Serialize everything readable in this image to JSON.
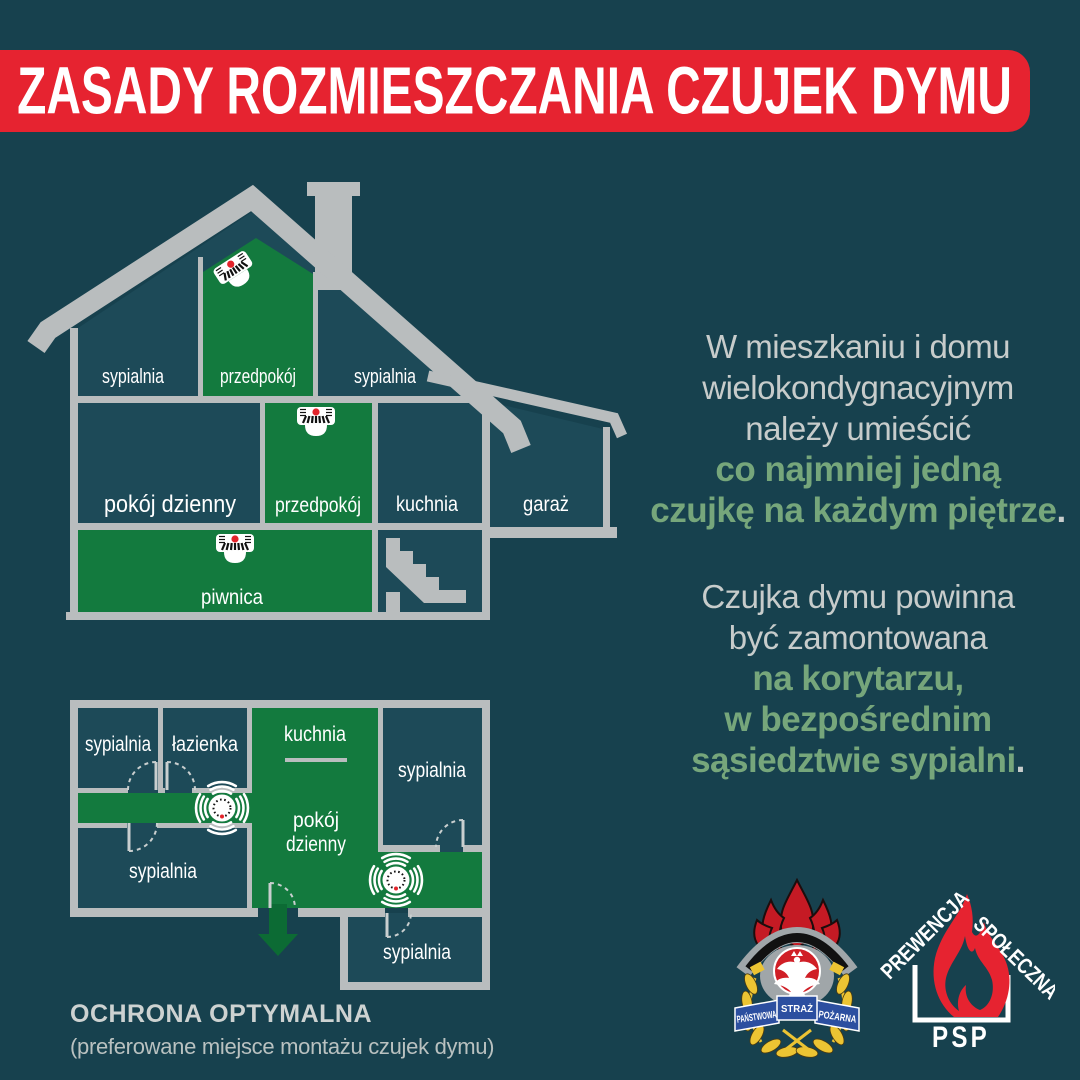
{
  "banner": {
    "title": "ZASADY ROZMIESZCZANIA CZUJEK DYMU"
  },
  "colors": {
    "background": "#17414e",
    "room_fill": "#1d4a58",
    "highlight_green": "#137a3e",
    "arrow_green": "#0c6b34",
    "wall_gray": "#b9bdbe",
    "banner_red": "#e62330",
    "detector_led_red": "#e3242b",
    "info_text_gray": "#c7cccb",
    "info_text_green": "#76a67b",
    "ribbon_blue": "#2c4fa0",
    "laurel_gold": "#ecc433",
    "helmet_gray": "#a0a6a9",
    "crest_flame_red": "#c51a24"
  },
  "icons": {
    "detector_side": "smoke-detector-side-view",
    "detector_top": "smoke-detector-top-view",
    "exit_arrow": "arrow-down",
    "stairs": "staircase",
    "doors": "door-swing-arc"
  },
  "house_section": {
    "attic_bedroom_left": "sypialnia",
    "attic_hallway": "przedpokój",
    "attic_bedroom_right": "sypialnia",
    "living_room": "pokój dzienny",
    "ground_hallway": "przedpokój",
    "kitchen": "kuchnia",
    "garage": "garaż",
    "cellar": "piwnica"
  },
  "floor_plan": {
    "bedroom_top_left": "sypialnia",
    "bathroom": "łazienka",
    "kitchen": "kuchnia",
    "living_room_line1": "pokój",
    "living_room_line2": "dzienny",
    "bedroom_top_right": "sypialnia",
    "bedroom_bottom_left": "sypialnia",
    "bedroom_bottom_right": "sypialnia"
  },
  "info": {
    "p1_l1": "W mieszkaniu i domu",
    "p1_l2": "wielokondygnacyjnym",
    "p1_l3": "należy umieścić",
    "p1_l4": "co najmniej jedną",
    "p1_l5": "czujkę na każdym piętrze",
    "p1_period": ".",
    "p2_l1": "Czujka dymu powinna",
    "p2_l2": "być zamontowana",
    "p2_l3": "na korytarzu,",
    "p2_l4": "w bezpośrednim",
    "p2_l5": "sąsiedztwie sypialni",
    "p2_period": "."
  },
  "caption": {
    "title": "OCHRONA OPTYMALNA",
    "subtitle": "(preferowane miejsce montażu czujek dymu)"
  },
  "logos": {
    "crest": {
      "word1": "PAŃSTWOWA",
      "word2": "STRAŻ",
      "word3": "POŻARNA"
    },
    "prewencja": {
      "word1": "PREWENCJA",
      "word2": "SPOŁECZNA",
      "word3": "PSP"
    }
  }
}
